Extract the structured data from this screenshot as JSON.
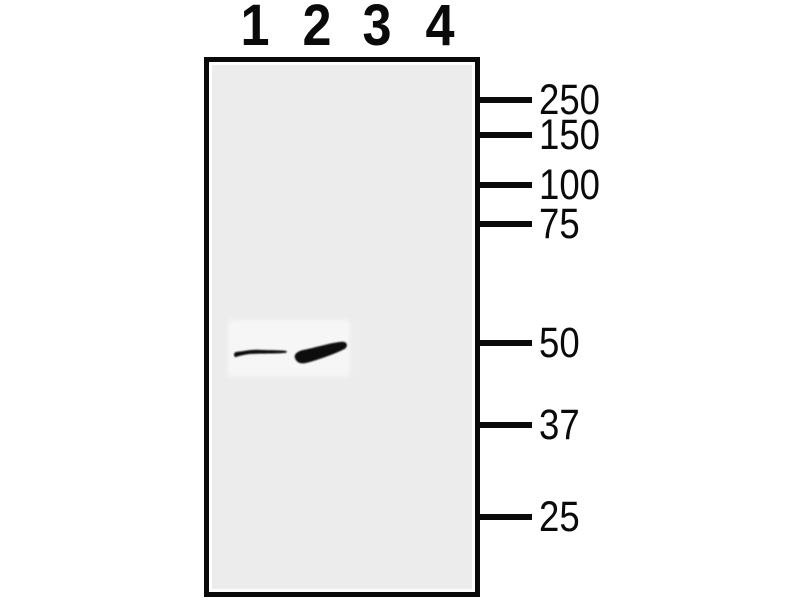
{
  "figure": {
    "type": "western-blot",
    "description": "Western blot membrane with four sample lanes and molecular weight ladder in kDa",
    "colors": {
      "background": "#ffffff",
      "gel": "#ececec",
      "patch": "#f6f6f6",
      "ink": "#0a0a0a",
      "band": "#0a0a0a"
    }
  },
  "lanes": [
    {
      "label": "1"
    },
    {
      "label": "2"
    },
    {
      "label": "3"
    },
    {
      "label": "4"
    }
  ],
  "mw_markers": [
    {
      "label": "250"
    },
    {
      "label": "150"
    },
    {
      "label": "100"
    },
    {
      "label": "75"
    },
    {
      "label": "50"
    },
    {
      "label": "37"
    },
    {
      "label": "25"
    }
  ],
  "bands": [
    {
      "lane": "1",
      "near_marker": "50",
      "intensity": "weak-thin"
    },
    {
      "lane": "2",
      "near_marker": "50",
      "intensity": "strong-thick"
    }
  ]
}
